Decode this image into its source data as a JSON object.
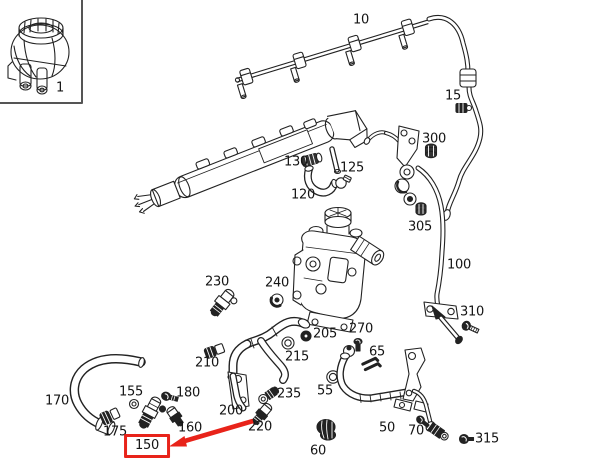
{
  "diagram": {
    "title": "fuel-system-parts-diagram",
    "background": "#ffffff",
    "line_color": "#222222",
    "highlight_color": "#e8231a",
    "inset_box": {
      "part": "1"
    },
    "labels": [
      {
        "id": "1",
        "text": "1",
        "x": 60,
        "y": 88
      },
      {
        "id": "10",
        "text": "10",
        "x": 361,
        "y": 20
      },
      {
        "id": "15",
        "text": "15",
        "x": 453,
        "y": 96
      },
      {
        "id": "130",
        "text": "130",
        "x": 296,
        "y": 162
      },
      {
        "id": "125",
        "text": "125",
        "x": 352,
        "y": 168
      },
      {
        "id": "120",
        "text": "120",
        "x": 303,
        "y": 195
      },
      {
        "id": "300",
        "text": "300",
        "x": 434,
        "y": 139
      },
      {
        "id": "305",
        "text": "305",
        "x": 420,
        "y": 227
      },
      {
        "id": "100",
        "text": "100",
        "x": 459,
        "y": 265
      },
      {
        "id": "310",
        "text": "310",
        "x": 472,
        "y": 312
      },
      {
        "id": "230",
        "text": "230",
        "x": 217,
        "y": 282
      },
      {
        "id": "240",
        "text": "240",
        "x": 277,
        "y": 283
      },
      {
        "id": "205",
        "text": "205",
        "x": 325,
        "y": 334
      },
      {
        "id": "270",
        "text": "270",
        "x": 361,
        "y": 329
      },
      {
        "id": "65",
        "text": "65",
        "x": 377,
        "y": 352
      },
      {
        "id": "215",
        "text": "215",
        "x": 297,
        "y": 357
      },
      {
        "id": "210",
        "text": "210",
        "x": 207,
        "y": 363
      },
      {
        "id": "55",
        "text": "55",
        "x": 325,
        "y": 391
      },
      {
        "id": "155",
        "text": "155",
        "x": 131,
        "y": 392
      },
      {
        "id": "180",
        "text": "180",
        "x": 188,
        "y": 393
      },
      {
        "id": "235",
        "text": "235",
        "x": 289,
        "y": 394
      },
      {
        "id": "170",
        "text": "170",
        "x": 57,
        "y": 401
      },
      {
        "id": "200",
        "text": "200",
        "x": 231,
        "y": 411
      },
      {
        "id": "160",
        "text": "160",
        "x": 190,
        "y": 428
      },
      {
        "id": "220",
        "text": "220",
        "x": 260,
        "y": 427
      },
      {
        "id": "175",
        "text": "175",
        "x": 115,
        "y": 432
      },
      {
        "id": "50",
        "text": "50",
        "x": 387,
        "y": 428
      },
      {
        "id": "70",
        "text": "70",
        "x": 416,
        "y": 431
      },
      {
        "id": "315",
        "text": "315",
        "x": 487,
        "y": 439
      },
      {
        "id": "60",
        "text": "60",
        "x": 318,
        "y": 451
      },
      {
        "id": "150",
        "text": "150",
        "x": 147,
        "y": 446,
        "highlighted": true
      }
    ],
    "annotation": {
      "type": "arrow",
      "target": "150",
      "color": "#e8231a"
    }
  }
}
